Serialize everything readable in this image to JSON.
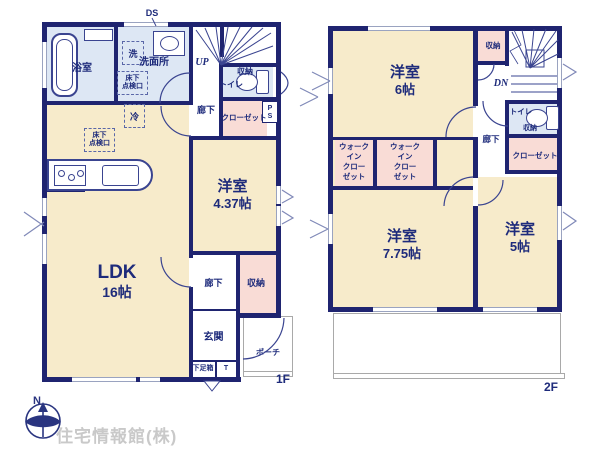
{
  "branding": {
    "company": "住宅情報館(株)"
  },
  "compass": {
    "north": "N"
  },
  "colors": {
    "wall": "#1f2470",
    "text": "#1e2b7b",
    "room_cream": "#f7ebcb",
    "room_blue": "#dde7f4",
    "room_pink": "#f9dcd6",
    "window_line": "#9aa3c0",
    "company_gray": "#c9c9c9"
  },
  "floor1": {
    "floor_label": "1F",
    "duct": "DS",
    "bathroom": "浴室",
    "washer": "洗",
    "washroom": "洗面所",
    "underfloor_hatch_a": [
      "床下",
      "点検口"
    ],
    "underfloor_hatch_b": [
      "床下",
      "点検口"
    ],
    "stairs": "UP",
    "toilet_storage": "収納",
    "toilet": "トイレ",
    "hallway_upper": "廊下",
    "closet": "クローゼット",
    "pipe_space": [
      "P",
      "S"
    ],
    "fridge": "冷",
    "ldk_name": "LDK",
    "ldk_size": "16帖",
    "bedroom_name": "洋室",
    "bedroom_size": "4.37帖",
    "hallway_lower": "廊下",
    "storage": "収納",
    "entrance": "玄関",
    "porch": "ポーチ",
    "shoe_box": "下足箱",
    "shoe_t": "T"
  },
  "floor2": {
    "floor_label": "2F",
    "bedroom6_name": "洋室",
    "bedroom6_size": "6帖",
    "storage_top": "収納",
    "stairs": "DN",
    "toilet": "トイレ",
    "toilet_storage": "収納",
    "hallway": "廊下",
    "closet": "クローゼット",
    "wic_a": [
      "ウォーク",
      "イン",
      "クロー",
      "ゼット"
    ],
    "wic_b": [
      "ウォーク",
      "イン",
      "クロー",
      "ゼット"
    ],
    "bedroom775_name": "洋室",
    "bedroom775_size": "7.75帖",
    "bedroom5_name": "洋室",
    "bedroom5_size": "5帖"
  }
}
